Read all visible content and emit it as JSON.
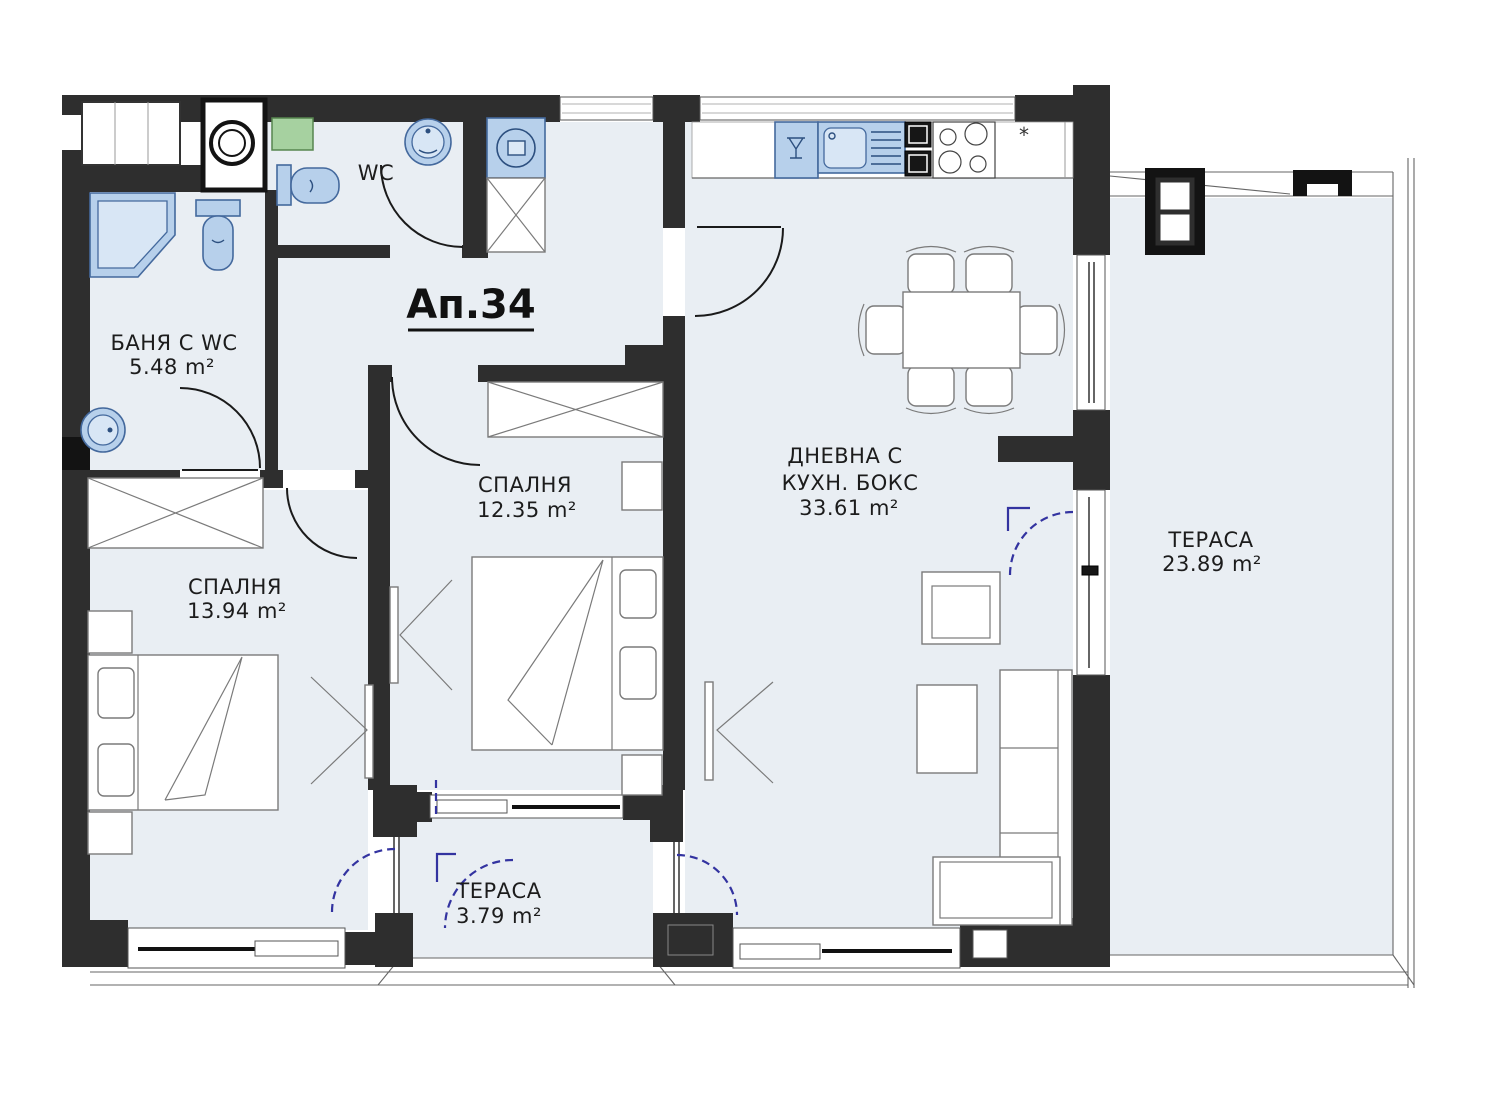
{
  "plan": {
    "apartment_label": "Ап.34",
    "rooms": [
      {
        "key": "bathroom",
        "label": "БАНЯ С WC",
        "area": "5.48 m²"
      },
      {
        "key": "wc",
        "label": "WC",
        "area": ""
      },
      {
        "key": "bedroom-middle",
        "label": "СПАЛНЯ",
        "area": "12.35 m²"
      },
      {
        "key": "bedroom-left",
        "label": "СПАЛНЯ",
        "area": "13.94 m²"
      },
      {
        "key": "living-kitchen",
        "label": "ДНЕВНА С",
        "label_line2": "КУХН. БОКС",
        "area": "33.61 m²"
      },
      {
        "key": "terrace-large",
        "label": "ТЕРАСА",
        "area": "23.89 m²"
      },
      {
        "key": "terrace-small",
        "label": "ТЕРАСА",
        "area": "3.79 m²"
      }
    ],
    "symbols": {
      "asterisk": "*"
    },
    "colors": {
      "wall": "#2e2e2e",
      "floor": "#e9eef3",
      "fixture_blue": "#b7d0eb",
      "fixture_blue_stroke": "#44699d",
      "door_swing_blue": "#3333a0",
      "accent_green": "#a6d1a0"
    }
  }
}
